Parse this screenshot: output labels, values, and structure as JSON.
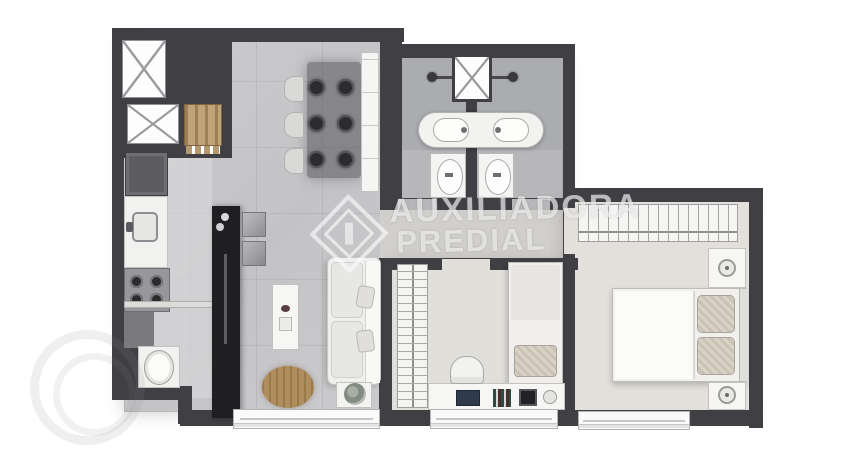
{
  "watermark": {
    "brand_line1": "AUXILIADORA",
    "brand_line2": "PREDIAL",
    "logo": "diamond-building-icon",
    "color": "#ffffff"
  },
  "palette": {
    "background": "#ffffff",
    "wall": "#3f3f44",
    "living_floor": "#c8c8ca",
    "kitchen_floor": "#d7d7d9",
    "bathroom_floor": "#abacaf",
    "hall_floor": "#d1cfcb",
    "bedroom_floor": "#e1dfda",
    "island_black": "#1f1f22",
    "wood_tan": "#b5996e",
    "furniture_white": "#f1f1f0"
  },
  "floorplan": {
    "type": "apartment-floor-plan-top-view",
    "labels_visible": false,
    "rooms": [
      {
        "name": "service-shafts",
        "features": [
          "elevator-shaft-x-upper",
          "elevator-shaft-x-lower",
          "wood-coat-rack"
        ]
      },
      {
        "name": "kitchen-laundry",
        "features": [
          "refrigerator",
          "counter-with-sink",
          "stove-4-burners",
          "lower-cabinet",
          "breakfast-shelf",
          "laundry-tub",
          "black-island-with-sink",
          "wall-cabinets"
        ]
      },
      {
        "name": "living-dining",
        "features": [
          "dining-table",
          "6-dark-chairs",
          "3-light-chairs",
          "sideboard-bench",
          "tv-rack",
          "round-wood-rug",
          "sofa-with-pillows",
          "plant-side-table",
          "window"
        ]
      },
      {
        "name": "bathroom-left",
        "features": [
          "shower-head",
          "vanity-sink",
          "toilet",
          "door-to-hall"
        ]
      },
      {
        "name": "bathroom-right",
        "features": [
          "shower-head",
          "vanity-sink",
          "toilet",
          "door-to-hall"
        ]
      },
      {
        "name": "bathroom-shaft",
        "features": [
          "duct-x-box"
        ]
      },
      {
        "name": "hall",
        "features": [
          "passage-living-to-bedrooms"
        ]
      },
      {
        "name": "bedroom-2",
        "features": [
          "wardrobe-hanger-strip",
          "single-bed-with-pillow",
          "desk",
          "desk-chair",
          "laptop",
          "books",
          "picture-frame",
          "window",
          "door"
        ]
      },
      {
        "name": "master-bedroom",
        "features": [
          "wardrobe-with-hangers",
          "double-bed",
          "two-pillows",
          "nightstand-lamp-upper",
          "nightstand-lamp-lower",
          "window",
          "door"
        ]
      }
    ]
  }
}
